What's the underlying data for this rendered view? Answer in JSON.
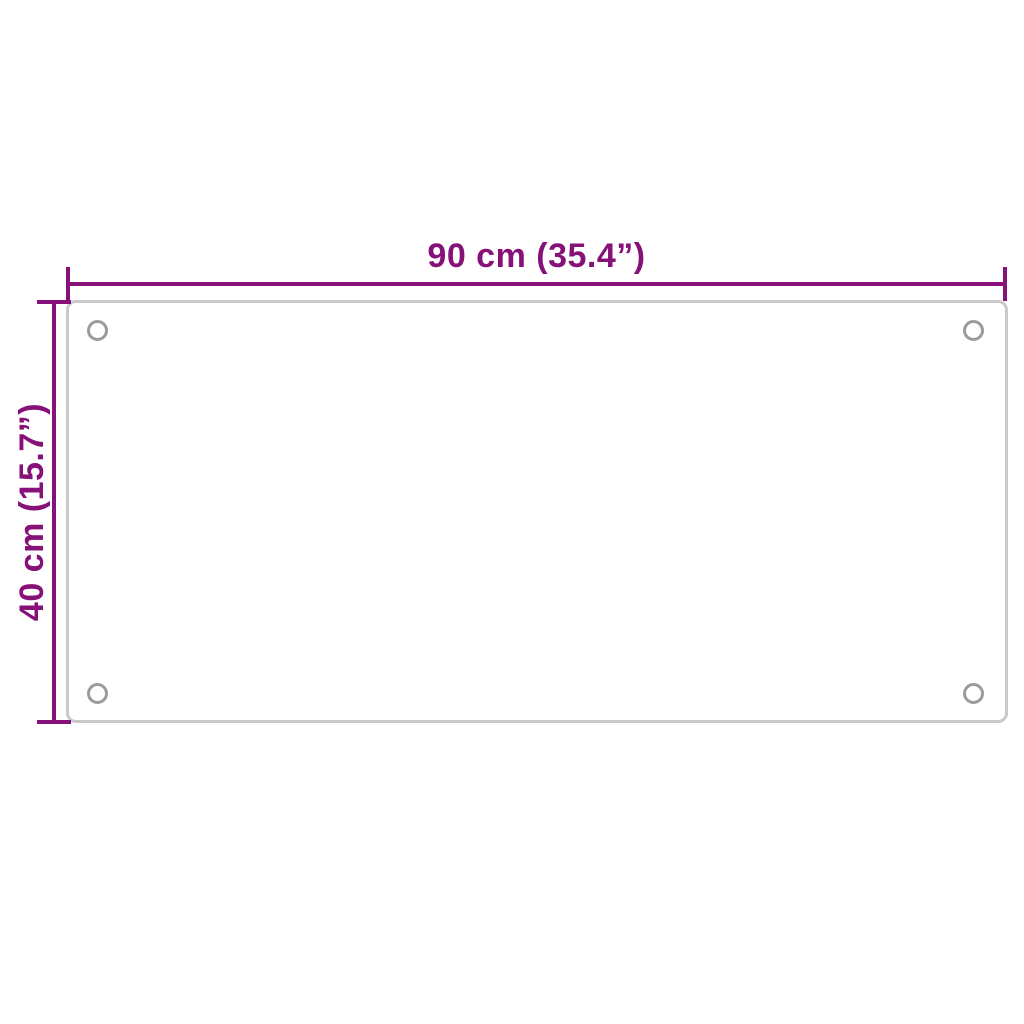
{
  "diagram": {
    "type": "product-dimension-diagram",
    "subject": "rectangular glass panel with four mounting holes",
    "dimensions": {
      "width_label": "90 cm (35.4”)",
      "height_label": "40 cm (15.7”)"
    },
    "colors": {
      "dimension_accent": "#861178",
      "panel_outline": "#c9c9c9",
      "hole_outline": "#9b9b9b",
      "background": "#ffffff"
    },
    "shapes": {
      "panel": "rounded rectangle outline",
      "holes": [
        "top-left",
        "top-right",
        "bottom-left",
        "bottom-right"
      ],
      "dimension_line_style": "T-capped end ticks, no arrowheads"
    }
  }
}
